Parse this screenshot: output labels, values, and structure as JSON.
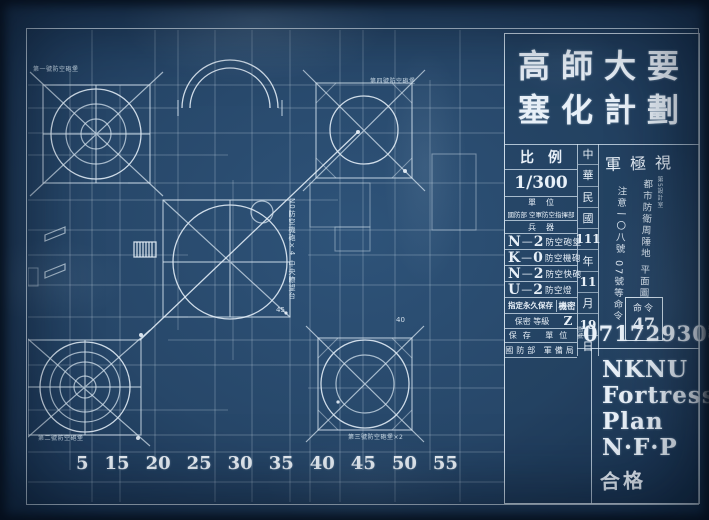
{
  "title_block": {
    "title_line1": "高師大要",
    "title_line2": "塞化計劃",
    "classification": "軍極視",
    "scale_label": "比例",
    "scale_value": "1/300",
    "unit_label": "單位",
    "unit_value": "國防部 空軍防空指揮部",
    "weapons_label": "兵器",
    "inventory": [
      {
        "code": "N",
        "dash": "—",
        "count": "2",
        "name": "防空砲堡"
      },
      {
        "code": "K",
        "dash": "—",
        "count": "0",
        "name": "防空機砲"
      },
      {
        "code": "N",
        "dash": "—",
        "count": "2",
        "name": "防空快砲"
      },
      {
        "code": "U",
        "dash": "—",
        "count": "2",
        "name": "防空燈"
      }
    ],
    "archive": {
      "row1_label": "指定永久保存",
      "row1_value": "機密",
      "row2_label": "保密 等級",
      "row2_value": "Z",
      "row3_label": "保存 單位",
      "row4_label": "國防部 軍備局",
      "serial_prefix": "圖號",
      "serial": "07172930",
      "serial_suffix": "號碼"
    },
    "date": [
      "中",
      "華",
      "民",
      "國",
      "111",
      "年",
      "11",
      "月",
      "19",
      "日"
    ],
    "notes": {
      "note1": "都市防衛周陲地 平面圖",
      "note1_small": "第5設計室",
      "note2": "注意一〇八號 07號等命令"
    },
    "order_box": {
      "label": "命令",
      "number": "47"
    }
  },
  "footer_block": {
    "line1": "NKNU",
    "line2": "Fortress",
    "line3": "Plan",
    "line4": "N·F·P",
    "stamp": "合格"
  },
  "drawing": {
    "labels": {
      "top_left": "第一號防空砲堡",
      "top_right": "第四號防空砲堡",
      "bottom_left": "第二號防空砲堡",
      "bottom_right": "第三號防空砲堡×2",
      "center_guns": "N0防空機砲×4",
      "center_tower": "中央瞭望台",
      "dim_45": "45",
      "dim_40": "40"
    },
    "scale_ticks": [
      "5",
      "15",
      "20",
      "25",
      "30",
      "35",
      "40",
      "45",
      "50",
      "55"
    ]
  }
}
